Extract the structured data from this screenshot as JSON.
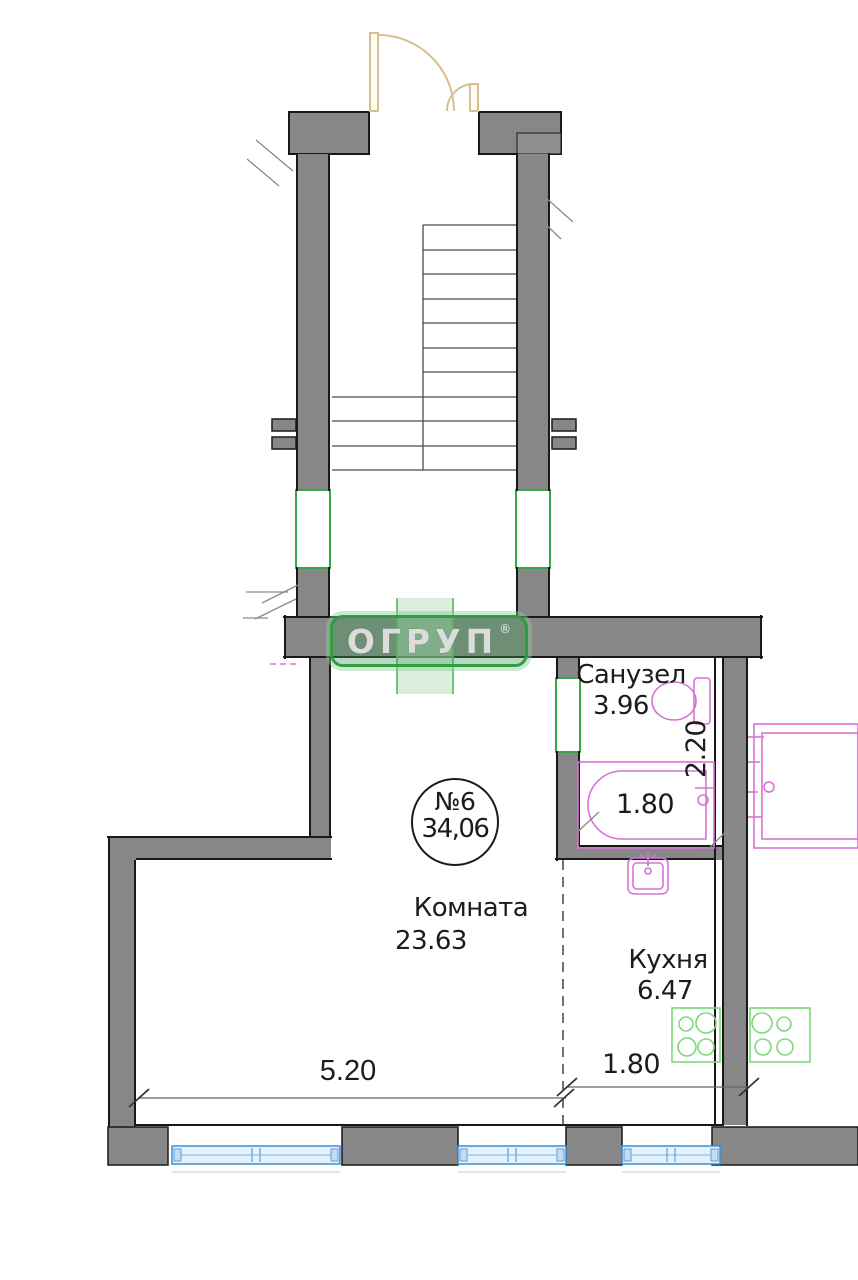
{
  "logo": {
    "text": "ОГРУП",
    "registered": "®"
  },
  "unit_badge": {
    "number": "№6",
    "area": "34,06"
  },
  "rooms": {
    "bathroom": {
      "name": "Санузел",
      "area": "3.96",
      "width": "1.80",
      "depth": "2.20"
    },
    "living": {
      "name": "Комната",
      "area": "23.63",
      "width": "5.20"
    },
    "kitchen": {
      "name": "Кухня",
      "area": "6.47",
      "width": "1.80"
    }
  },
  "colors": {
    "wall_gray": "#878787",
    "outline_black": "#181818",
    "stair_window_green": "#35a845",
    "street_window_blue": "#3f8fd2",
    "fixture_magenta": "#d573d5",
    "stove_green": "#7cd87c",
    "door_tan": "#d9bf8f",
    "logo_green": "#2f9e42"
  }
}
